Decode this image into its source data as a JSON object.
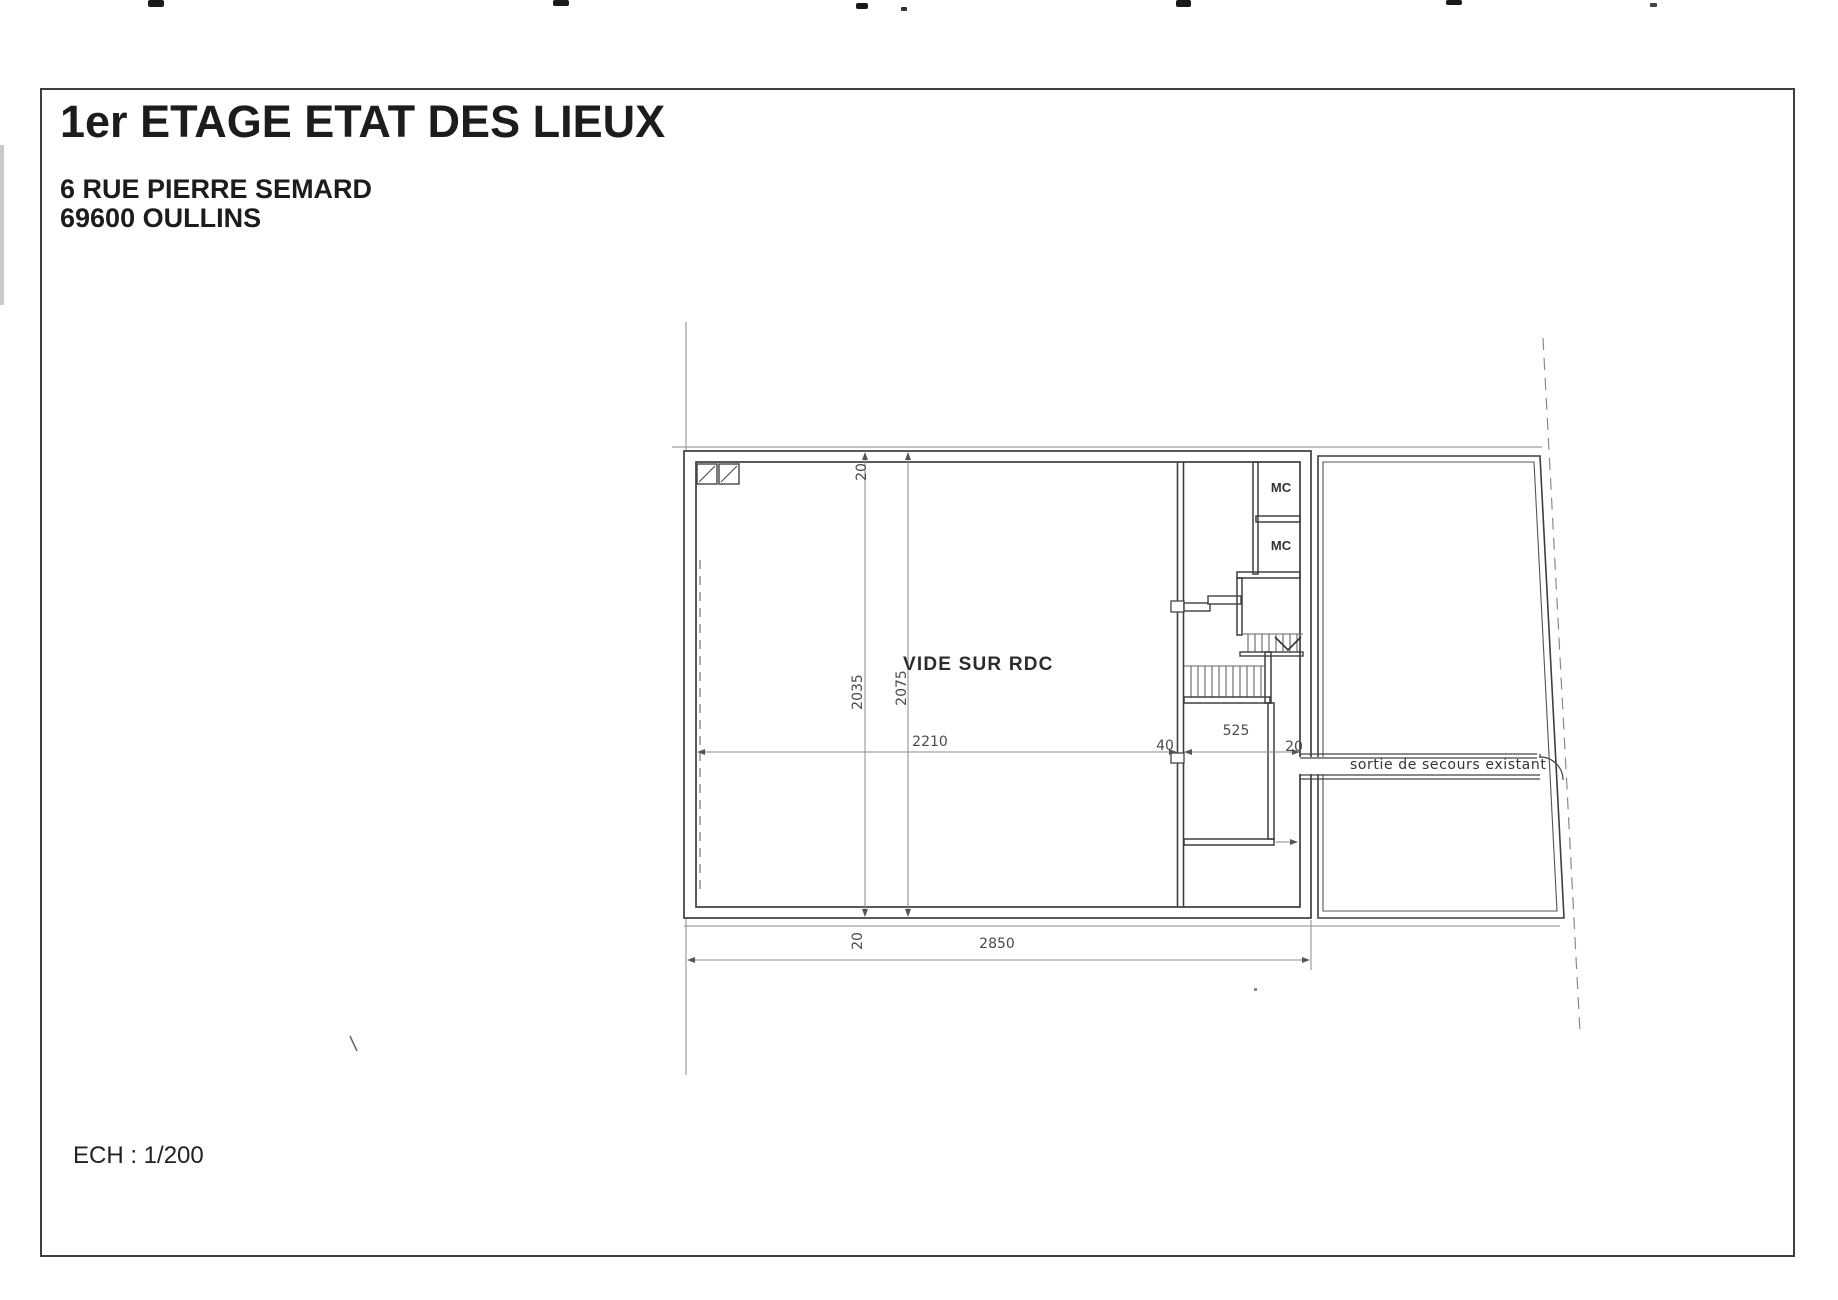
{
  "document": {
    "title": "1er ETAGE ETAT DES LIEUX",
    "address_line_1": "6 RUE PIERRE SEMARD",
    "address_line_2": "69600 OULLINS",
    "scale": "ECH : 1/200"
  },
  "plan": {
    "labels": {
      "void_over_ground_floor": "VIDE SUR RDC",
      "wc_1": "MC",
      "wc_2": "MC",
      "emergency_exit": "sortie de secours existant"
    },
    "dimensions": {
      "wall_top": "20",
      "left_span": "2035",
      "inner_span": "2075",
      "main_room_width": "2210",
      "center_wall": "40",
      "stair_bay_width": "525",
      "right_wall": "20",
      "wall_bottom": "20",
      "overall_width": "2850"
    }
  },
  "colors": {
    "paper": "#ffffff",
    "ink": "#1c1c1c",
    "wall_line": "#3e3e3e",
    "thin_line": "#8a8a8a",
    "dim_text": "#4a4a4a"
  }
}
